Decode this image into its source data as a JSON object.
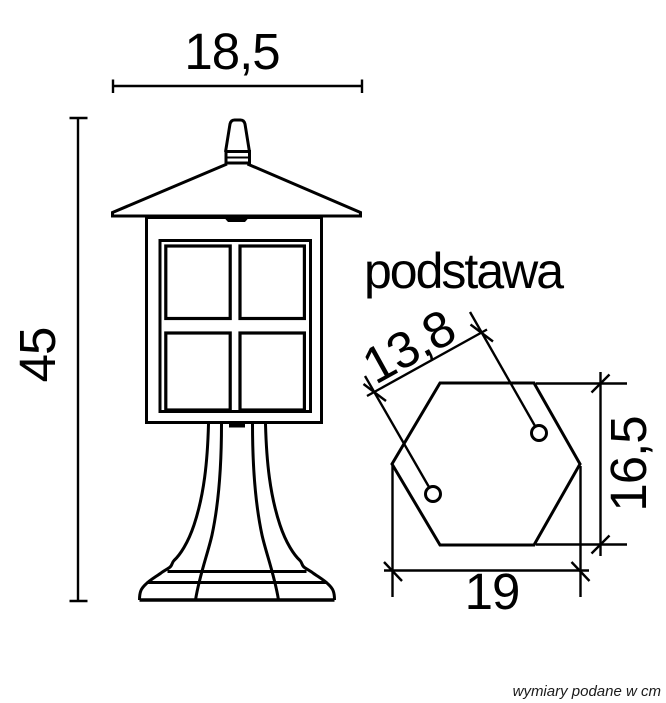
{
  "page": {
    "background_color": "#ffffff",
    "line_color": "#000000"
  },
  "labels": {
    "base_view_title": "podstawa",
    "footer_note": "wymiary podane w cm"
  },
  "dimensions": {
    "lantern_width": "18,5",
    "lantern_height": "45",
    "base_hole_spacing": "13,8",
    "base_depth": "16,5",
    "base_width": "19"
  }
}
